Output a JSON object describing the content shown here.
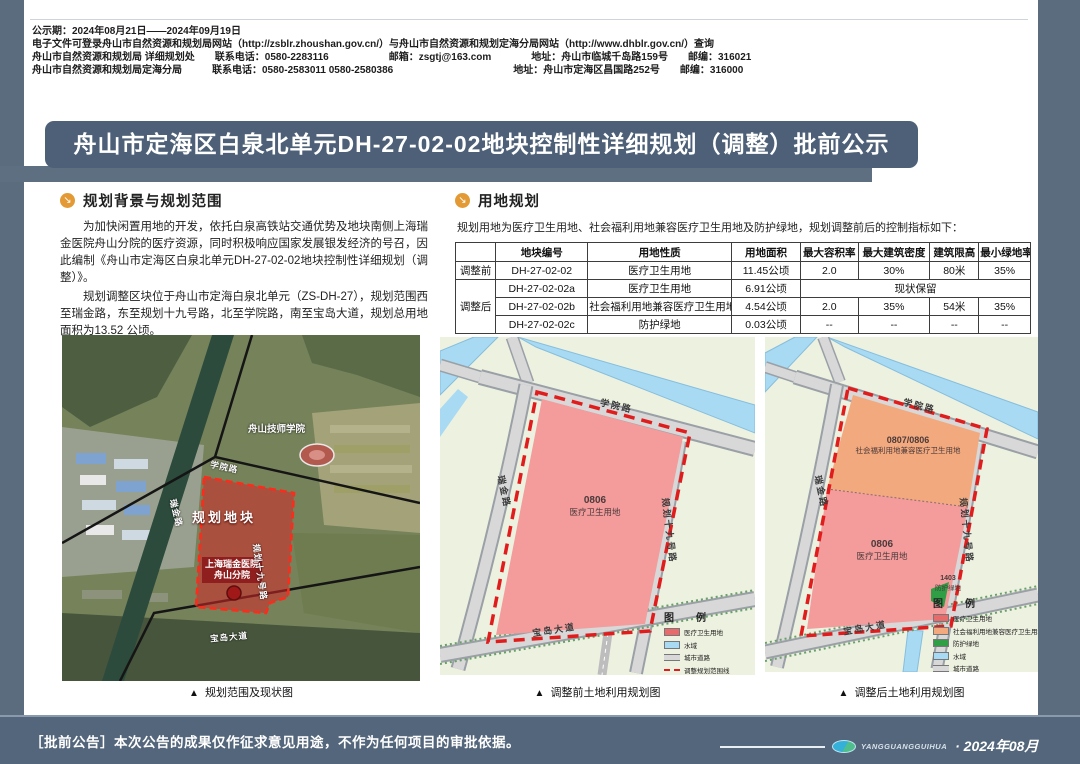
{
  "page": {
    "title": "舟山市定海区白泉北单元DH-27-02-02地块控制性详细规划（调整）批前公示",
    "header_lines": [
      "公示期：2024年08月21日——2024年09月19日",
      "电子文件可登录舟山市自然资源和规划局网站（http://zsblr.zhoushan.gov.cn/）与舟山市自然资源和规划定海分局网站（http://www.dhblr.gov.cn/）查询",
      "舟山市自然资源和规划局 详细规划处　　联系电话：0580-2283116　　　　　　邮箱：zsgtj@163.com　　　　地址：舟山市临城千岛路159号　　邮编：316021",
      "舟山市自然资源和规划局定海分局　　　联系电话：0580-2583011 0580-2580386　　　　　　　　　　　　地址：舟山市定海区昌国路252号　　邮编：316000"
    ],
    "footer": {
      "notice": "［批前公告］本次公告的成果仅作征求意见用途，不作为任何项目的审批依据。",
      "brand": "YANGGUANGGUIHUA",
      "date": "· 2024年08月"
    }
  },
  "icons": {
    "section_bullet": "↘",
    "caption_marker": "▲"
  },
  "sections": {
    "background": {
      "heading": "规划背景与规划范围",
      "paragraphs": [
        "为加快闲置用地的开发，依托白泉高铁站交通优势及地块南侧上海瑞金医院舟山分院的医疗资源，同时积极响应国家发展银发经济的号召，因此编制《舟山市定海区白泉北单元DH-27-02-02地块控制性详细规划（调整）》。",
        "规划调整区块位于舟山市定海白泉北单元（ZS-DH-27），规划范围西至瑞金路，东至规划十九号路，北至学院路，南至宝岛大道，规划总用地面积为13.52 公顷。"
      ]
    },
    "landuse": {
      "heading": "用地规划",
      "intro": "规划用地为医疗卫生用地、社会福利用地兼容医疗卫生用地及防护绿地，规划调整前后的控制指标如下："
    }
  },
  "land_table": {
    "headers": [
      "",
      "地块编号",
      "用地性质",
      "用地面积",
      "最大容积率",
      "最大建筑密度",
      "建筑限高",
      "最小绿地率"
    ],
    "row_groups": [
      {
        "label": "调整前",
        "rows": [
          [
            "DH-27-02-02",
            "医疗卫生用地",
            "11.45公顷",
            "2.0",
            "30%",
            "80米",
            "35%"
          ]
        ]
      },
      {
        "label": "调整后",
        "rows": [
          [
            "DH-27-02-02a",
            "医疗卫生用地",
            "6.91公顷",
            "现状保留"
          ],
          [
            "DH-27-02-02b",
            "社会福利用地兼容医疗卫生用地",
            "4.54公顷",
            "2.0",
            "35%",
            "54米",
            "35%"
          ],
          [
            "DH-27-02-02c",
            "防护绿地",
            "0.03公顷",
            "--",
            "--",
            "--",
            "--"
          ]
        ]
      }
    ]
  },
  "roads": {
    "north": "学院路",
    "west": "瑞金路",
    "east": "规划十九号路",
    "south": "宝岛大道"
  },
  "maps": {
    "site": {
      "caption": "规划范围及现状图",
      "labels": {
        "college": "舟山技师学院",
        "plot": "规划地块",
        "hospital": "上海瑞金医院舟山分院"
      }
    },
    "before": {
      "caption": "调整前土地利用规划图",
      "parcel": {
        "code": "0806",
        "use": "医疗卫生用地"
      },
      "legend": {
        "title": "图　例",
        "items": [
          {
            "label": "医疗卫生用地",
            "color": "#e96a6a",
            "kind": "fill"
          },
          {
            "label": "水域",
            "color": "#a8daf3",
            "kind": "fill"
          },
          {
            "label": "城市道路",
            "color": "#d8d8d8",
            "kind": "road"
          },
          {
            "label": "调整规划范围线",
            "color": "#e01c1c",
            "kind": "dash"
          }
        ]
      }
    },
    "after": {
      "caption": "调整后土地利用规划图",
      "parcels": [
        {
          "code": "0807/0806",
          "use": "社会福利用地兼容医疗卫生用地"
        },
        {
          "code": "0806",
          "use": "医疗卫生用地"
        },
        {
          "code": "1403",
          "use": "防护绿地"
        }
      ],
      "legend": {
        "title": "图　例",
        "items": [
          {
            "label": "医疗卫生用地",
            "color": "#e96a6a",
            "kind": "fill"
          },
          {
            "label": "社会福利用地兼容医疗卫生用地",
            "color": "#f3a97e",
            "kind": "fill"
          },
          {
            "label": "防护绿地",
            "color": "#2f9e44",
            "kind": "fill"
          },
          {
            "label": "水域",
            "color": "#a8daf3",
            "kind": "fill"
          },
          {
            "label": "城市道路",
            "color": "#d8d8d8",
            "kind": "road"
          },
          {
            "label": "调整规划范围线",
            "color": "#e01c1c",
            "kind": "dash"
          }
        ]
      }
    }
  },
  "colors": {
    "frame": "#5b6c7e",
    "banner": "#4d6078",
    "footer": "#54667b",
    "section_icon": "#e39a35",
    "medical_parcel": "#f49b9b",
    "welfare_parcel": "#f3a97e",
    "protective_green": "#2f9e44",
    "water": "#a8daf3",
    "road": "#d8d8d8",
    "boundary_dash": "#e01c1c",
    "site_highlight": "#d62828"
  }
}
